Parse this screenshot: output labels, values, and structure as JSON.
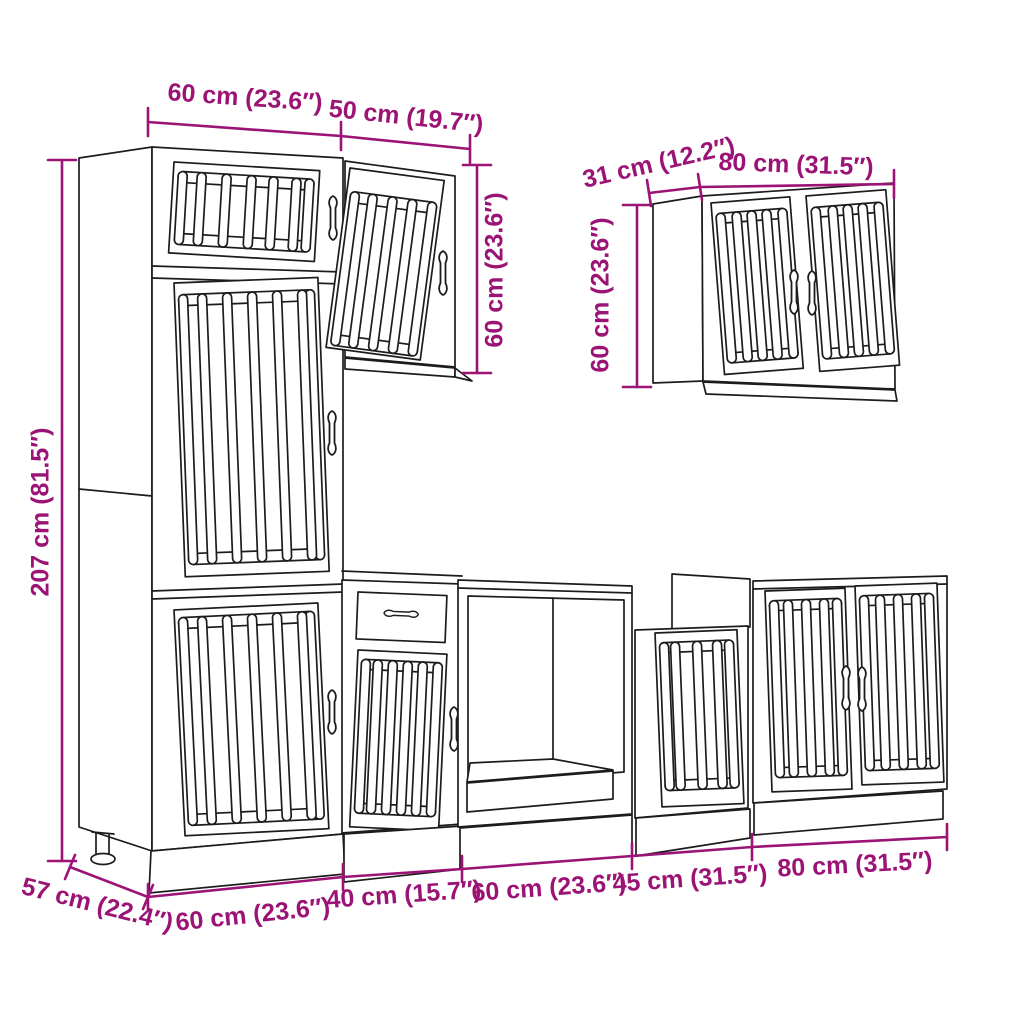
{
  "title": "Kitchen cabinet set dimension diagram",
  "colors": {
    "dimension": "#9c1376",
    "line": "#1c1c1c",
    "background": "#ffffff"
  },
  "dimensions": {
    "tall_cabinet_width": "60 cm (23.6″)",
    "wall_cabinet_50_width": "50 cm (19.7″)",
    "wall_cabinet_50_height": "60 cm (23.6″)",
    "wall_cabinet_80_depth": "31 cm (12.2″)",
    "wall_cabinet_80_width": "80 cm (31.5″)",
    "wall_cabinet_80_height": "60 cm (23.6″)",
    "tall_cabinet_height": "207 cm (81.5″)",
    "base_depth": "57 cm (22.4″)",
    "base_widths": [
      "60 cm (23.6″)",
      "40 cm (15.7″)",
      "60 cm (23.6″)",
      "45 cm (31.5″)",
      "80 cm (31.5″)"
    ]
  }
}
